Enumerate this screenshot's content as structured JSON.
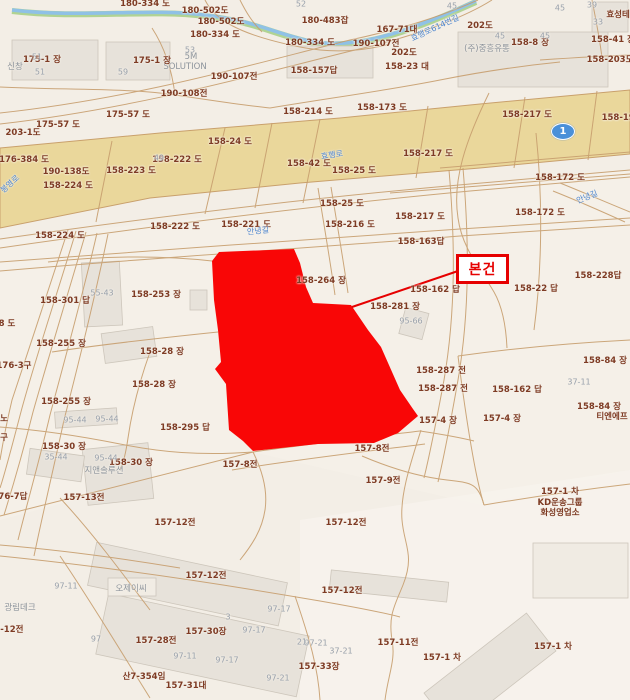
{
  "map": {
    "type": "cadastral-map",
    "callout": {
      "label": "본건"
    },
    "route_shield": {
      "number": "1"
    },
    "colors": {
      "background": "#f3eee6",
      "road_band_fill": "#ead79b",
      "parcel_line": "#c79e6e",
      "parcel_label_text": "#7e3b24",
      "gray_label_text": "#98a0ab",
      "blue_road_text": "#4e86cf",
      "highlight_parcel": "#f90606",
      "callout_red": "#e60000",
      "stream_blue": "#8fc1e6",
      "stream_green": "#a9cf8a",
      "building_fill": "#e7e2da",
      "route_shield_blue": "#4a90d9"
    },
    "labels": [
      {
        "text": "180-334 도",
        "x": 145,
        "y": 3,
        "cls": "p"
      },
      {
        "text": "180-502도",
        "x": 205,
        "y": 10,
        "cls": "p"
      },
      {
        "text": "180-502도",
        "x": 221,
        "y": 21,
        "cls": "p"
      },
      {
        "text": "180-334 도",
        "x": 215,
        "y": 34,
        "cls": "p"
      },
      {
        "text": "180-334 도",
        "x": 310,
        "y": 42,
        "cls": "p"
      },
      {
        "text": "180-483잡",
        "x": 325,
        "y": 20,
        "cls": "p"
      },
      {
        "text": "167-71대",
        "x": 397,
        "y": 29,
        "cls": "p"
      },
      {
        "text": "202도",
        "x": 480,
        "y": 25,
        "cls": "p"
      },
      {
        "text": "202도",
        "x": 404,
        "y": 52,
        "cls": "p"
      },
      {
        "text": "190-107전",
        "x": 376,
        "y": 43,
        "cls": "p"
      },
      {
        "text": "190-107전",
        "x": 234,
        "y": 76,
        "cls": "p"
      },
      {
        "text": "190-108전",
        "x": 184,
        "y": 93,
        "cls": "p"
      },
      {
        "text": "158-23 대",
        "x": 407,
        "y": 66,
        "cls": "p"
      },
      {
        "text": "158-157답",
        "x": 314,
        "y": 70,
        "cls": "p"
      },
      {
        "text": "158-8 장",
        "x": 530,
        "y": 42,
        "cls": "p"
      },
      {
        "text": "158-41 장",
        "x": 613,
        "y": 39,
        "cls": "p"
      },
      {
        "text": "158-203도",
        "x": 610,
        "y": 59,
        "cls": "p"
      },
      {
        "text": "효성테크",
        "x": 622,
        "y": 14,
        "cls": "c"
      },
      {
        "text": "(주)중흥유통",
        "x": 487,
        "y": 48,
        "cls": "gc"
      },
      {
        "text": "5M",
        "x": 191,
        "y": 57,
        "cls": "gc"
      },
      {
        "text": "SOLUTION",
        "x": 185,
        "y": 67,
        "cls": "gc"
      },
      {
        "text": "신창",
        "x": 15,
        "y": 66,
        "cls": "gc"
      },
      {
        "text": "158-214 도",
        "x": 308,
        "y": 111,
        "cls": "p"
      },
      {
        "text": "158-173 도",
        "x": 382,
        "y": 107,
        "cls": "p"
      },
      {
        "text": "158-217 도",
        "x": 527,
        "y": 114,
        "cls": "p"
      },
      {
        "text": "158-191도",
        "x": 625,
        "y": 117,
        "cls": "p"
      },
      {
        "text": "175-1 장",
        "x": 42,
        "y": 59,
        "cls": "p"
      },
      {
        "text": "175-1 장",
        "x": 152,
        "y": 60,
        "cls": "p"
      },
      {
        "text": "175-57 도",
        "x": 128,
        "y": 114,
        "cls": "p"
      },
      {
        "text": "175-57 도",
        "x": 58,
        "y": 124,
        "cls": "p"
      },
      {
        "text": "203-1도",
        "x": 23,
        "y": 132,
        "cls": "p"
      },
      {
        "text": "176-384 도",
        "x": 24,
        "y": 159,
        "cls": "p"
      },
      {
        "text": "158-24 도",
        "x": 230,
        "y": 141,
        "cls": "p"
      },
      {
        "text": "158-42 도",
        "x": 309,
        "y": 163,
        "cls": "p"
      },
      {
        "text": "158-222 도",
        "x": 177,
        "y": 159,
        "cls": "p"
      },
      {
        "text": "158-25 도",
        "x": 354,
        "y": 170,
        "cls": "p"
      },
      {
        "text": "158-217 도",
        "x": 428,
        "y": 153,
        "cls": "p"
      },
      {
        "text": "158-172 도",
        "x": 560,
        "y": 177,
        "cls": "p"
      },
      {
        "text": "158-172 도",
        "x": 540,
        "y": 212,
        "cls": "p"
      },
      {
        "text": "190-138도",
        "x": 66,
        "y": 171,
        "cls": "p"
      },
      {
        "text": "158-223 도",
        "x": 131,
        "y": 170,
        "cls": "p"
      },
      {
        "text": "158-224 도",
        "x": 68,
        "y": 185,
        "cls": "p"
      },
      {
        "text": "158-224 도",
        "x": 60,
        "y": 235,
        "cls": "p"
      },
      {
        "text": "158-222 도",
        "x": 175,
        "y": 226,
        "cls": "p"
      },
      {
        "text": "158-221 도",
        "x": 246,
        "y": 224,
        "cls": "p"
      },
      {
        "text": "158-216 도",
        "x": 350,
        "y": 224,
        "cls": "p"
      },
      {
        "text": "158-217 도",
        "x": 420,
        "y": 216,
        "cls": "p"
      },
      {
        "text": "158-25 도",
        "x": 342,
        "y": 203,
        "cls": "p"
      },
      {
        "text": "158-163답",
        "x": 421,
        "y": 241,
        "cls": "p"
      },
      {
        "text": "158-264 장",
        "x": 321,
        "y": 280,
        "cls": "p"
      },
      {
        "text": "158-281 장",
        "x": 395,
        "y": 306,
        "cls": "p"
      },
      {
        "text": "158-162 답",
        "x": 435,
        "y": 289,
        "cls": "p"
      },
      {
        "text": "158-228답",
        "x": 598,
        "y": 275,
        "cls": "p"
      },
      {
        "text": "158-22 답",
        "x": 536,
        "y": 288,
        "cls": "p"
      },
      {
        "text": "158-253 장",
        "x": 156,
        "y": 294,
        "cls": "p"
      },
      {
        "text": "158-301 답",
        "x": 65,
        "y": 300,
        "cls": "p"
      },
      {
        "text": "8 도",
        "x": 7,
        "y": 323,
        "cls": "p"
      },
      {
        "text": "158-255 장",
        "x": 61,
        "y": 343,
        "cls": "p"
      },
      {
        "text": "158-28 장",
        "x": 162,
        "y": 351,
        "cls": "p"
      },
      {
        "text": "158-28 장",
        "x": 154,
        "y": 384,
        "cls": "p"
      },
      {
        "text": "158-255 장",
        "x": 66,
        "y": 401,
        "cls": "p"
      },
      {
        "text": "176-3구",
        "x": 14,
        "y": 365,
        "cls": "p"
      },
      {
        "text": "158-295 답",
        "x": 185,
        "y": 427,
        "cls": "p"
      },
      {
        "text": "노",
        "x": 4,
        "y": 418,
        "cls": "p"
      },
      {
        "text": "구",
        "x": 4,
        "y": 437,
        "cls": "p"
      },
      {
        "text": "158-30 장",
        "x": 64,
        "y": 446,
        "cls": "p"
      },
      {
        "text": "158-30 장",
        "x": 131,
        "y": 462,
        "cls": "p"
      },
      {
        "text": "158-287 전",
        "x": 441,
        "y": 370,
        "cls": "p"
      },
      {
        "text": "158-287 전",
        "x": 443,
        "y": 388,
        "cls": "p"
      },
      {
        "text": "158-162 답",
        "x": 517,
        "y": 389,
        "cls": "p"
      },
      {
        "text": "158-84 장",
        "x": 605,
        "y": 360,
        "cls": "p"
      },
      {
        "text": "158-84 장",
        "x": 599,
        "y": 406,
        "cls": "p"
      },
      {
        "text": "티엔에프",
        "x": 612,
        "y": 416,
        "cls": "c"
      },
      {
        "text": "157-4 장",
        "x": 438,
        "y": 420,
        "cls": "p"
      },
      {
        "text": "157-4 장",
        "x": 502,
        "y": 418,
        "cls": "p"
      },
      {
        "text": "157-8전",
        "x": 240,
        "y": 464,
        "cls": "p"
      },
      {
        "text": "157-8전",
        "x": 372,
        "y": 448,
        "cls": "p"
      },
      {
        "text": "157-9전",
        "x": 383,
        "y": 480,
        "cls": "p"
      },
      {
        "text": "176-7답",
        "x": 10,
        "y": 496,
        "cls": "p"
      },
      {
        "text": "157-13전",
        "x": 84,
        "y": 497,
        "cls": "p"
      },
      {
        "text": "157-12전",
        "x": 175,
        "y": 522,
        "cls": "p"
      },
      {
        "text": "157-12전",
        "x": 346,
        "y": 522,
        "cls": "p"
      },
      {
        "text": "157-12전",
        "x": 206,
        "y": 575,
        "cls": "p"
      },
      {
        "text": "157-12전",
        "x": 342,
        "y": 590,
        "cls": "p"
      },
      {
        "text": "157-12전",
        "x": 3,
        "y": 629,
        "cls": "p"
      },
      {
        "text": "157-28전",
        "x": 156,
        "y": 640,
        "cls": "p"
      },
      {
        "text": "157-30장",
        "x": 206,
        "y": 631,
        "cls": "p"
      },
      {
        "text": "157-33장",
        "x": 319,
        "y": 666,
        "cls": "p"
      },
      {
        "text": "157-11전",
        "x": 398,
        "y": 642,
        "cls": "p"
      },
      {
        "text": "157-1 차",
        "x": 442,
        "y": 657,
        "cls": "p"
      },
      {
        "text": "157-1 차",
        "x": 553,
        "y": 646,
        "cls": "p"
      },
      {
        "text": "산7-354임",
        "x": 144,
        "y": 676,
        "cls": "p"
      },
      {
        "text": "157-31대",
        "x": 186,
        "y": 685,
        "cls": "p"
      },
      {
        "text": "157-1 차",
        "x": 560,
        "y": 491,
        "cls": "p"
      },
      {
        "text": "KD운송그룹",
        "x": 560,
        "y": 502,
        "cls": "c"
      },
      {
        "text": "화성영업소",
        "x": 560,
        "y": 512,
        "cls": "c"
      },
      {
        "text": "51",
        "x": 37,
        "y": 57,
        "cls": "g"
      },
      {
        "text": "51",
        "x": 40,
        "y": 72,
        "cls": "g"
      },
      {
        "text": "59",
        "x": 123,
        "y": 72,
        "cls": "g"
      },
      {
        "text": "53",
        "x": 190,
        "y": 50,
        "cls": "g"
      },
      {
        "text": "52",
        "x": 301,
        "y": 4,
        "cls": "g"
      },
      {
        "text": "45",
        "x": 452,
        "y": 6,
        "cls": "g"
      },
      {
        "text": "45",
        "x": 560,
        "y": 8,
        "cls": "g"
      },
      {
        "text": "39",
        "x": 592,
        "y": 5,
        "cls": "g"
      },
      {
        "text": "33",
        "x": 598,
        "y": 22,
        "cls": "g"
      },
      {
        "text": "45",
        "x": 500,
        "y": 36,
        "cls": "g"
      },
      {
        "text": "45",
        "x": 545,
        "y": 36,
        "cls": "g"
      },
      {
        "text": "49",
        "x": 159,
        "y": 158,
        "cls": "g"
      },
      {
        "text": "55-43",
        "x": 102,
        "y": 293,
        "cls": "g"
      },
      {
        "text": "95-66",
        "x": 411,
        "y": 321,
        "cls": "g"
      },
      {
        "text": "37-11",
        "x": 579,
        "y": 382,
        "cls": "g"
      },
      {
        "text": "95-44",
        "x": 75,
        "y": 420,
        "cls": "g"
      },
      {
        "text": "95-44",
        "x": 107,
        "y": 419,
        "cls": "g"
      },
      {
        "text": "35-44",
        "x": 56,
        "y": 457,
        "cls": "g"
      },
      {
        "text": "95-44",
        "x": 106,
        "y": 458,
        "cls": "g"
      },
      {
        "text": "지앤솔루션",
        "x": 104,
        "y": 470,
        "cls": "gc"
      },
      {
        "text": "97-11",
        "x": 66,
        "y": 586,
        "cls": "g"
      },
      {
        "text": "오제이씨",
        "x": 131,
        "y": 588,
        "cls": "gc"
      },
      {
        "text": "광림데크",
        "x": 20,
        "y": 607,
        "cls": "gc"
      },
      {
        "text": "97-11",
        "x": 185,
        "y": 656,
        "cls": "g"
      },
      {
        "text": "97",
        "x": 96,
        "y": 639,
        "cls": "g"
      },
      {
        "text": "3",
        "x": 228,
        "y": 617,
        "cls": "g"
      },
      {
        "text": "97-17",
        "x": 279,
        "y": 609,
        "cls": "g"
      },
      {
        "text": "97-17",
        "x": 254,
        "y": 630,
        "cls": "g"
      },
      {
        "text": "97-17",
        "x": 227,
        "y": 660,
        "cls": "g"
      },
      {
        "text": "97-21",
        "x": 278,
        "y": 678,
        "cls": "g"
      },
      {
        "text": "97-21",
        "x": 316,
        "y": 643,
        "cls": "g"
      },
      {
        "text": "37-21",
        "x": 341,
        "y": 651,
        "cls": "g"
      },
      {
        "text": "21",
        "x": 302,
        "y": 642,
        "cls": "g"
      },
      {
        "text": "효행로614번길",
        "x": 435,
        "y": 28,
        "cls": "b",
        "rot": -25
      },
      {
        "text": "효행로",
        "x": 332,
        "y": 155,
        "cls": "b",
        "rot": -8
      },
      {
        "text": "봉영로",
        "x": 10,
        "y": 184,
        "cls": "b",
        "rot": -42
      },
      {
        "text": "안녕길",
        "x": 258,
        "y": 231,
        "cls": "b",
        "rot": -6
      },
      {
        "text": "안녕길",
        "x": 587,
        "y": 197,
        "cls": "b",
        "rot": -22
      }
    ]
  }
}
